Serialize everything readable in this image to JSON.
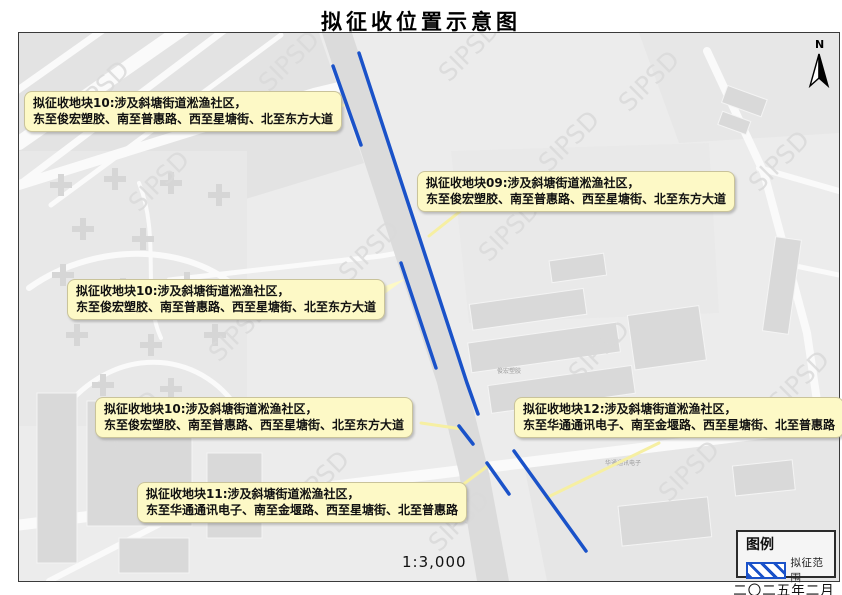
{
  "title": "拟征收位置示意图",
  "map": {
    "scale_label": "1:3,000",
    "date_label": "二〇二五年二月",
    "north_label": "N",
    "watermark": "SIPSD",
    "building_labels": [
      "俊宏塑胶",
      "华通通讯电子"
    ],
    "colors": {
      "boundary_line": "#1a52c9",
      "callout_bg": "#fdf9c6",
      "leader_line": "#f6efa2",
      "map_bg": "#ececec",
      "road_fill": "#dbdbdb"
    }
  },
  "legend": {
    "title": "图例",
    "items": [
      {
        "symbol": "blue-diagonal-hatch",
        "label": "拟征范围"
      }
    ]
  },
  "callouts": [
    {
      "parcel": "10",
      "line1": "拟征收地块10:涉及斜塘街道淞渔社区，",
      "line2": "东至俊宏塑胶、南至普惠路、西至星塘街、北至东方大道"
    },
    {
      "parcel": "09",
      "line1": "拟征收地块09:涉及斜塘街道淞渔社区，",
      "line2": "东至俊宏塑胶、南至普惠路、西至星塘街、北至东方大道"
    },
    {
      "parcel": "10",
      "line1": "拟征收地块10:涉及斜塘街道淞渔社区，",
      "line2": "东至俊宏塑胶、南至普惠路、西至星塘街、北至东方大道"
    },
    {
      "parcel": "10",
      "line1": "拟征收地块10:涉及斜塘街道淞渔社区，",
      "line2": "东至俊宏塑胶、南至普惠路、西至星塘街、北至东方大道"
    },
    {
      "parcel": "12",
      "line1": "拟征收地块12:涉及斜塘街道淞渔社区，",
      "line2": "东至华通通讯电子、南至金堰路、西至星塘街、北至普惠路"
    },
    {
      "parcel": "11",
      "line1": "拟征收地块11:涉及斜塘街道淞渔社区，",
      "line2": "东至华通通讯电子、南至金堰路、西至星塘街、北至普惠路"
    }
  ]
}
